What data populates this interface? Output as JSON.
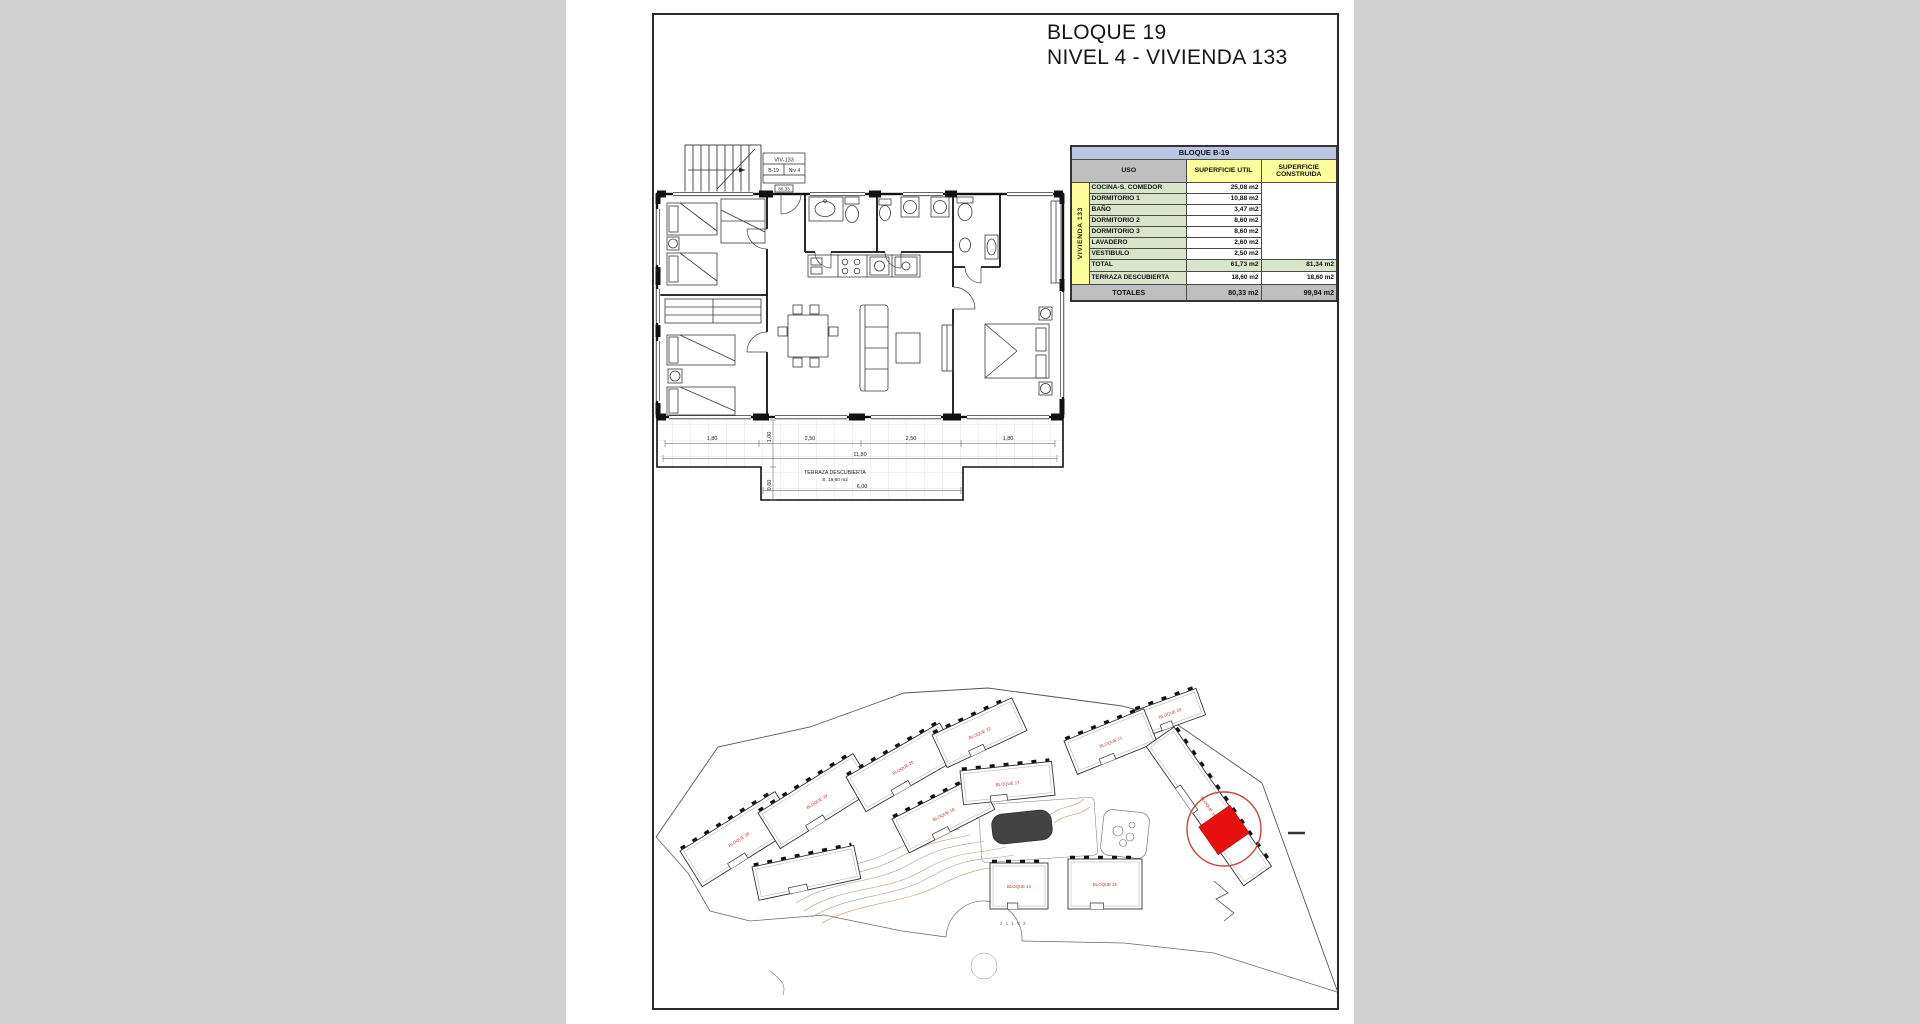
{
  "page": {
    "background": "#d0d0d0",
    "title_line1": "BLOQUE 19",
    "title_line2": "NIVEL 4 - VIVIENDA 133"
  },
  "floor_plan": {
    "unit_box": {
      "row1": "VIV-133",
      "cell_block": "B-19",
      "cell_level": "Niv 4",
      "area_tag": "80,33"
    },
    "terrace": {
      "label": "TERRAZA DESCUBIERTA",
      "area": "S. 18,60 m2",
      "dims_top": [
        "1,80",
        "2,50",
        "2,50",
        "1,80"
      ],
      "dim_width": "11,80",
      "dim_bottom": "6,00",
      "dim_left_top": "1,00",
      "dim_left_bottom": "0,60"
    }
  },
  "area_table": {
    "title": "BLOQUE B-19",
    "strip_label": "VIVIENDA 133",
    "columns": [
      "USO",
      "SUPERFICIE UTIL",
      "SUPERFICIE CONSTRUIDA"
    ],
    "rows": [
      {
        "uso": "COCINA-S. COMEDOR",
        "util": "25,08 m2"
      },
      {
        "uso": "DORMITORIO 1",
        "util": "10,88 m2"
      },
      {
        "uso": "BAÑO",
        "util": "3,47 m2"
      },
      {
        "uso": "DORMITORIO 2",
        "util": "8,60 m2"
      },
      {
        "uso": "DORMITORIO 3",
        "util": "8,60 m2"
      },
      {
        "uso": "LAVADERO",
        "util": "2,60 m2"
      },
      {
        "uso": "VESTIBULO",
        "util": "2,50 m2"
      }
    ],
    "total_row": {
      "uso": "TOTAL",
      "util": "61,73 m2",
      "construida": "81,34 m2"
    },
    "terraza_row": {
      "uso": "TERRAZA DESCUBIERTA",
      "util": "18,60 m2",
      "construida": "18,60 m2"
    },
    "totales_row": {
      "label": "TOTALES",
      "util": "80,33 m2",
      "construida": "99,94 m2"
    },
    "colors": {
      "title_bg": "#b9c7e4",
      "header_gray": "#bfbfbf",
      "header_yellow": "#ffff9c",
      "row_green": "#d8e5c9",
      "totales_bg": "#bfbfbf"
    }
  },
  "site_plan": {
    "label_color": "#b03a2e",
    "highlight_color": "#e80f0f",
    "highlight_ring_color": "#c0493a",
    "footnote": "2 1 1 V 2",
    "buildings": [
      {
        "x": 26,
        "y": 166,
        "w": 112,
        "h": 42,
        "a": -32,
        "label": "BLOQUE 28"
      },
      {
        "x": 104,
        "y": 128,
        "w": 112,
        "h": 42,
        "a": -32,
        "label": "BLOQUE 29"
      },
      {
        "x": 192,
        "y": 92,
        "w": 108,
        "h": 40,
        "a": -30,
        "label": "BLOQUE 20"
      },
      {
        "x": 278,
        "y": 50,
        "w": 88,
        "h": 36,
        "a": -25,
        "label": "BLOQUE 22"
      },
      {
        "x": 480,
        "y": 26,
        "w": 66,
        "h": 28,
        "a": -20,
        "label": "BLOQUE 23"
      },
      {
        "x": 238,
        "y": 134,
        "w": 96,
        "h": 38,
        "a": -27,
        "label": "BLOQUE 18"
      },
      {
        "x": 410,
        "y": 56,
        "w": 86,
        "h": 36,
        "a": -22,
        "label": "BLOQUE 21"
      },
      {
        "x": 306,
        "y": 86,
        "w": 92,
        "h": 34,
        "a": -6,
        "label": "BLOQUE 17"
      },
      {
        "x": 98,
        "y": 182,
        "w": 104,
        "h": 34,
        "a": -12,
        "label": ""
      },
      {
        "x": 520,
        "y": 42,
        "w": 170,
        "h": 34,
        "a": 55,
        "label": "BLOQUE 19"
      },
      {
        "x": 336,
        "y": 178,
        "w": 58,
        "h": 46,
        "a": 0,
        "label": "BLOQUE 14"
      },
      {
        "x": 414,
        "y": 174,
        "w": 74,
        "h": 50,
        "a": 0,
        "label": "BLOQUE 15"
      }
    ]
  }
}
